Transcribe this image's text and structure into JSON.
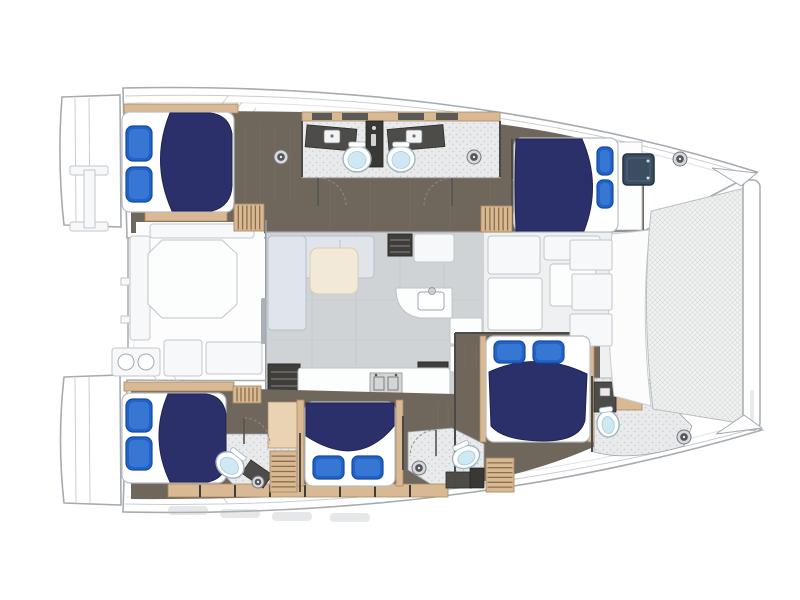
{
  "meta": {
    "diagram_type": "catamaran-yacht-floor-plan",
    "view": "top-down-deck-plan",
    "orientation": "bow-right",
    "cabin_count": 5,
    "head_count": 5,
    "visible_text": ""
  },
  "colors": {
    "outline": "#a6abb1",
    "outline_light": "#c9cdd1",
    "floor_taupe": "#6f665c",
    "floor_taupe_dark": "#5f564d",
    "floor_line": "#83796d",
    "wood_tan": "#d9b993",
    "wood_tan_light": "#ead3b2",
    "wood_tan_dark": "#a98a63",
    "wood_tan_line": "#8a6f4b",
    "bath_floor": "#e8eaeb",
    "bath_speck": "#c6cbce",
    "counter_dark": "#4d4c49",
    "column_dark": "#393835",
    "toilet_blue": "#cfe9f4",
    "toilet_rim": "#9fb4bf",
    "bed_navy": "#2b2f6a",
    "bed_navy_dark": "#20244f",
    "pillow_blue": "#2063c9",
    "pillow_blue_dark": "#174a9e",
    "pillow_blue_light": "#4f8ade",
    "salon_floor": "#d0d3d5",
    "salon_line": "#bfc3c6",
    "sofa_gray": "#dfe5eb",
    "sofa_line": "#b6c1cb",
    "cream": "#f2e9d8",
    "cream_line": "#d9cdb3",
    "hatch_slate": "#3b4d61",
    "hatch_slate_dark": "#243240",
    "tramp_bg": "#f0f1f1",
    "tramp_line": "#d9dadb",
    "dark_opening": "#403e3b"
  },
  "cabins": [
    {
      "id": "port-aft-cabin",
      "position": "top-left",
      "bed": "double",
      "pillow_side": "left"
    },
    {
      "id": "port-forward-cabin",
      "position": "top-right",
      "bed": "double",
      "pillow_side": "right"
    },
    {
      "id": "starboard-aft-cabin",
      "position": "bottom-left",
      "bed": "double",
      "pillow_side": "left"
    },
    {
      "id": "starboard-mid-cabin",
      "position": "bottom-center",
      "bed": "double",
      "pillow_side": "bottom"
    },
    {
      "id": "starboard-forward-cabin",
      "position": "bottom-right",
      "bed": "double",
      "pillow_side": "top"
    }
  ],
  "beds": [
    {
      "id": "bed-port-aft",
      "base": {
        "x": 122,
        "y": 112,
        "w": 112,
        "h": 100,
        "rx": 8
      },
      "duvet": "M170,113 Q150,162 172,211 L212,211 Q231,206 232,186 L232,134 Q229,115 210,113 Z",
      "pillows": [
        {
          "x": 126,
          "y": 126,
          "w": 26,
          "h": 35,
          "rx": 7
        },
        {
          "x": 126,
          "y": 167,
          "w": 26,
          "h": 35,
          "rx": 7
        }
      ]
    },
    {
      "id": "bed-port-forward",
      "base": {
        "x": 514,
        "y": 138,
        "w": 104,
        "h": 94,
        "rx": 8
      },
      "duvet": "M516,139 L582,139 Q602,185 584,231 L516,231 Q514,185 516,139 Z",
      "pillows": [
        {
          "x": 597,
          "y": 147,
          "w": 16,
          "h": 28,
          "rx": 6
        },
        {
          "x": 597,
          "y": 180,
          "w": 16,
          "h": 28,
          "rx": 6
        }
      ]
    },
    {
      "id": "bed-starboard-aft",
      "base": {
        "x": 122,
        "y": 393,
        "w": 104,
        "h": 90,
        "rx": 8
      },
      "duvet": "M168,394 Q149,438 170,482 L208,482 Q226,478 226,460 L226,414 Q223,396 206,394 Z",
      "pillows": [
        {
          "x": 126,
          "y": 399,
          "w": 26,
          "h": 33,
          "rx": 7
        },
        {
          "x": 126,
          "y": 437,
          "w": 26,
          "h": 33,
          "rx": 7
        }
      ]
    },
    {
      "id": "bed-starboard-mid",
      "base": {
        "x": 305,
        "y": 402,
        "w": 90,
        "h": 84,
        "rx": 8
      },
      "duvet": "M306,403 L394,403 L394,426 Q358,470 306,436 Z",
      "pillows": [
        {
          "x": 313,
          "y": 456,
          "w": 31,
          "h": 23,
          "rx": 6
        },
        {
          "x": 352,
          "y": 456,
          "w": 31,
          "h": 23,
          "rx": 6
        }
      ]
    },
    {
      "id": "bed-starboard-forward",
      "base": {
        "x": 486,
        "y": 336,
        "w": 104,
        "h": 106,
        "rx": 8
      },
      "duvet": "M489,372 Q538,350 587,374 L585,420 Q580,441 544,441 Q504,441 491,426 Z",
      "pillows": [
        {
          "x": 494,
          "y": 341,
          "w": 31,
          "h": 22,
          "rx": 6
        },
        {
          "x": 533,
          "y": 341,
          "w": 31,
          "h": 22,
          "rx": 6
        }
      ]
    }
  ],
  "toilets": [
    {
      "id": "toilet-port-head-left",
      "cx": 357,
      "cy": 159,
      "rx": 14,
      "ry": 13,
      "rot": 0
    },
    {
      "id": "toilet-port-head-right",
      "cx": 401,
      "cy": 159,
      "rx": 14,
      "ry": 13,
      "rot": 0
    },
    {
      "id": "toilet-starboard-aft-head",
      "cx": 230,
      "cy": 465,
      "rx": 15,
      "ry": 12,
      "rot": 38
    },
    {
      "id": "toilet-starboard-mid-head",
      "cx": 466,
      "cy": 457,
      "rx": 14,
      "ry": 11,
      "rot": -25
    },
    {
      "id": "toilet-starboard-forward-head",
      "cx": 608,
      "cy": 424,
      "rx": 11,
      "ry": 13,
      "rot": -8
    }
  ],
  "shower_heads": [
    {
      "id": "shower-port-left",
      "cx": 281,
      "cy": 157,
      "r": 7
    },
    {
      "id": "shower-port-right",
      "cx": 474,
      "cy": 157,
      "r": 7
    },
    {
      "id": "shower-starboard-aft",
      "cx": 258,
      "cy": 482,
      "r": 6
    },
    {
      "id": "shower-starboard-mid",
      "cx": 419,
      "cy": 468,
      "r": 7
    },
    {
      "id": "deck-fitting-bow-port",
      "cx": 680,
      "cy": 159,
      "r": 7
    },
    {
      "id": "deck-fitting-bow-starboard",
      "cx": 684,
      "cy": 437,
      "r": 7
    }
  ],
  "stairs": [
    {
      "id": "louver-port-aft",
      "x": 234,
      "y": 204,
      "w": 30,
      "h": 27,
      "dir": "v",
      "steps": 6
    },
    {
      "id": "louver-port-forward",
      "x": 481,
      "y": 206,
      "w": 31,
      "h": 26,
      "dir": "v",
      "steps": 6
    },
    {
      "id": "stairs-starboard-aft",
      "x": 270,
      "y": 451,
      "w": 27,
      "h": 41,
      "dir": "h",
      "steps": 7
    },
    {
      "id": "stairs-starboard-forward",
      "x": 486,
      "y": 458,
      "w": 28,
      "h": 34,
      "dir": "h",
      "steps": 6
    },
    {
      "id": "louver-starboard-wardrobe",
      "x": 233,
      "y": 386,
      "w": 28,
      "h": 17,
      "dir": "v",
      "steps": 6
    }
  ],
  "hatches": [
    {
      "id": "forepeak-hatch",
      "x": 623,
      "y": 154,
      "w": 31,
      "h": 31
    }
  ]
}
